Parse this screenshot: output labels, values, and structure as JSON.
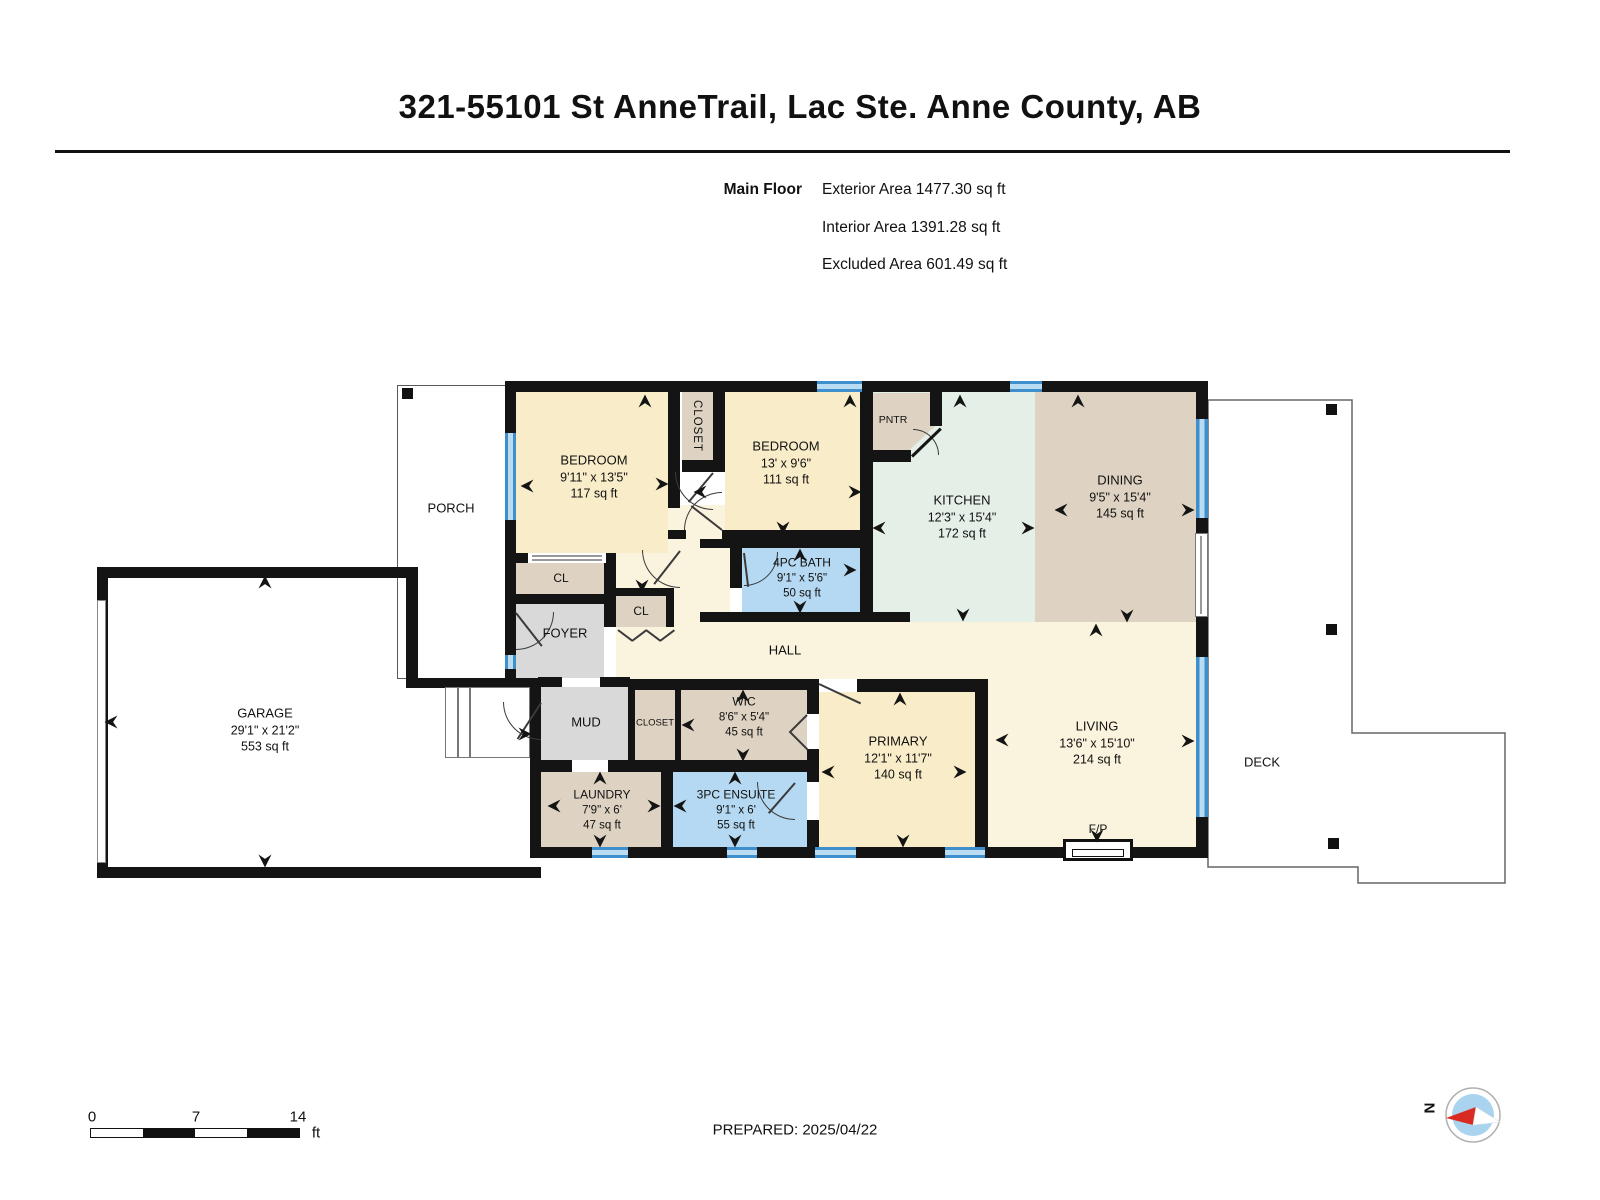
{
  "header": {
    "title": "321-55101 St AnneTrail, Lac Ste. Anne County, AB",
    "floor_label": "Main Floor",
    "stats": [
      "Exterior Area 1477.30 sq ft",
      "Interior Area 1391.28 sq ft",
      "Excluded Area 601.49 sq ft"
    ]
  },
  "rooms": {
    "bedroom1": {
      "name": "BEDROOM",
      "dims": "9'11\" x 13'5\"",
      "area": "117 sq ft"
    },
    "bedroom2": {
      "name": "BEDROOM",
      "dims": "13' x 9'6\"",
      "area": "111 sq ft"
    },
    "bath": {
      "name": "4PC BATH",
      "dims": "9'1\" x 5'6\"",
      "area": "50 sq ft"
    },
    "kitchen": {
      "name": "KITCHEN",
      "dims": "12'3\" x 15'4\"",
      "area": "172 sq ft"
    },
    "dining": {
      "name": "DINING",
      "dims": "9'5\" x 15'4\"",
      "area": "145 sq ft"
    },
    "wic": {
      "name": "WIC",
      "dims": "8'6\" x 5'4\"",
      "area": "45 sq ft"
    },
    "laundry": {
      "name": "LAUNDRY",
      "dims": "7'9\" x 6'",
      "area": "47 sq ft"
    },
    "ensuite": {
      "name": "3PC ENSUITE",
      "dims": "9'1\" x 6'",
      "area": "55 sq ft"
    },
    "primary": {
      "name": "PRIMARY",
      "dims": "12'1\" x 11'7\"",
      "area": "140 sq ft"
    },
    "living": {
      "name": "LIVING",
      "dims": "13'6\" x 15'10\"",
      "area": "214 sq ft"
    },
    "garage": {
      "name": "GARAGE",
      "dims": "29'1\" x 21'2\"",
      "area": "553 sq ft"
    }
  },
  "labels": {
    "porch": "PORCH",
    "deck": "DECK",
    "hall": "HALL",
    "foyer": "FOYER",
    "mud": "MUD",
    "closet_vertical": "CLOSET",
    "closet_mud": "CLOSET",
    "cl_bedroom": "CL",
    "cl_hall": "CL",
    "pntr": "PNTR",
    "fireplace": "F/P"
  },
  "footer": {
    "prepared": "PREPARED: 2025/04/22",
    "scale": {
      "start": "0",
      "mid": "7",
      "end": "14",
      "unit": "ft"
    },
    "compass": {
      "north": "N"
    }
  },
  "colors": {
    "room_cream": "#f9edc9",
    "hall_cream": "#faf3de",
    "tan": "#ded3c2",
    "mint": "#e4efe8",
    "bath_blue": "#b5d9f2",
    "gray": "#d9d9d9",
    "wall": "#141414",
    "window_blue": "#3f8fcc"
  }
}
